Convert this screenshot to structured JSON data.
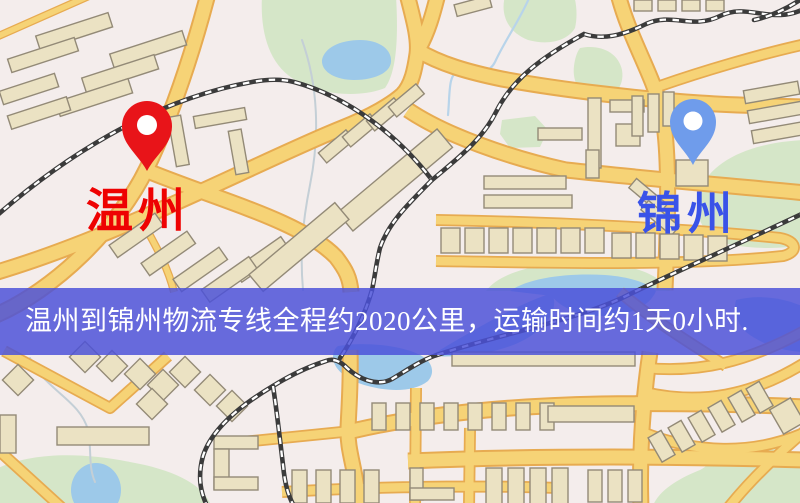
{
  "origin": {
    "name": "温州"
  },
  "destination": {
    "name": "锦州"
  },
  "banner": {
    "text": "温州到锦州物流专线全程约2020公里，运输时间约1天0小时.",
    "distance": "2020公里",
    "duration": "1天0小时"
  },
  "icons": {
    "origin_pin": "red-map-pin-icon",
    "destination_pin": "blue-map-pin-icon"
  },
  "colors": {
    "map_background": "#f4edec",
    "road_fill": "#f6d376",
    "road_edge": "#e7ab51",
    "railway_dark": "#3b3b3b",
    "railway_light": "#ffffff",
    "building_fill": "#ebe2c3",
    "building_edge": "#938a77",
    "park_green": "#d5e6c8",
    "water_blue": "#9dc9e9",
    "stream": "#c4cfd6",
    "creek": "#b8d4ea",
    "banner_bg": "#4b51d9",
    "banner_text": "#ffffff",
    "origin_pin": "#e81419",
    "origin_label": "#ee0202",
    "destination_pin": "#6f9ceb",
    "destination_label": "#3a53e8"
  }
}
